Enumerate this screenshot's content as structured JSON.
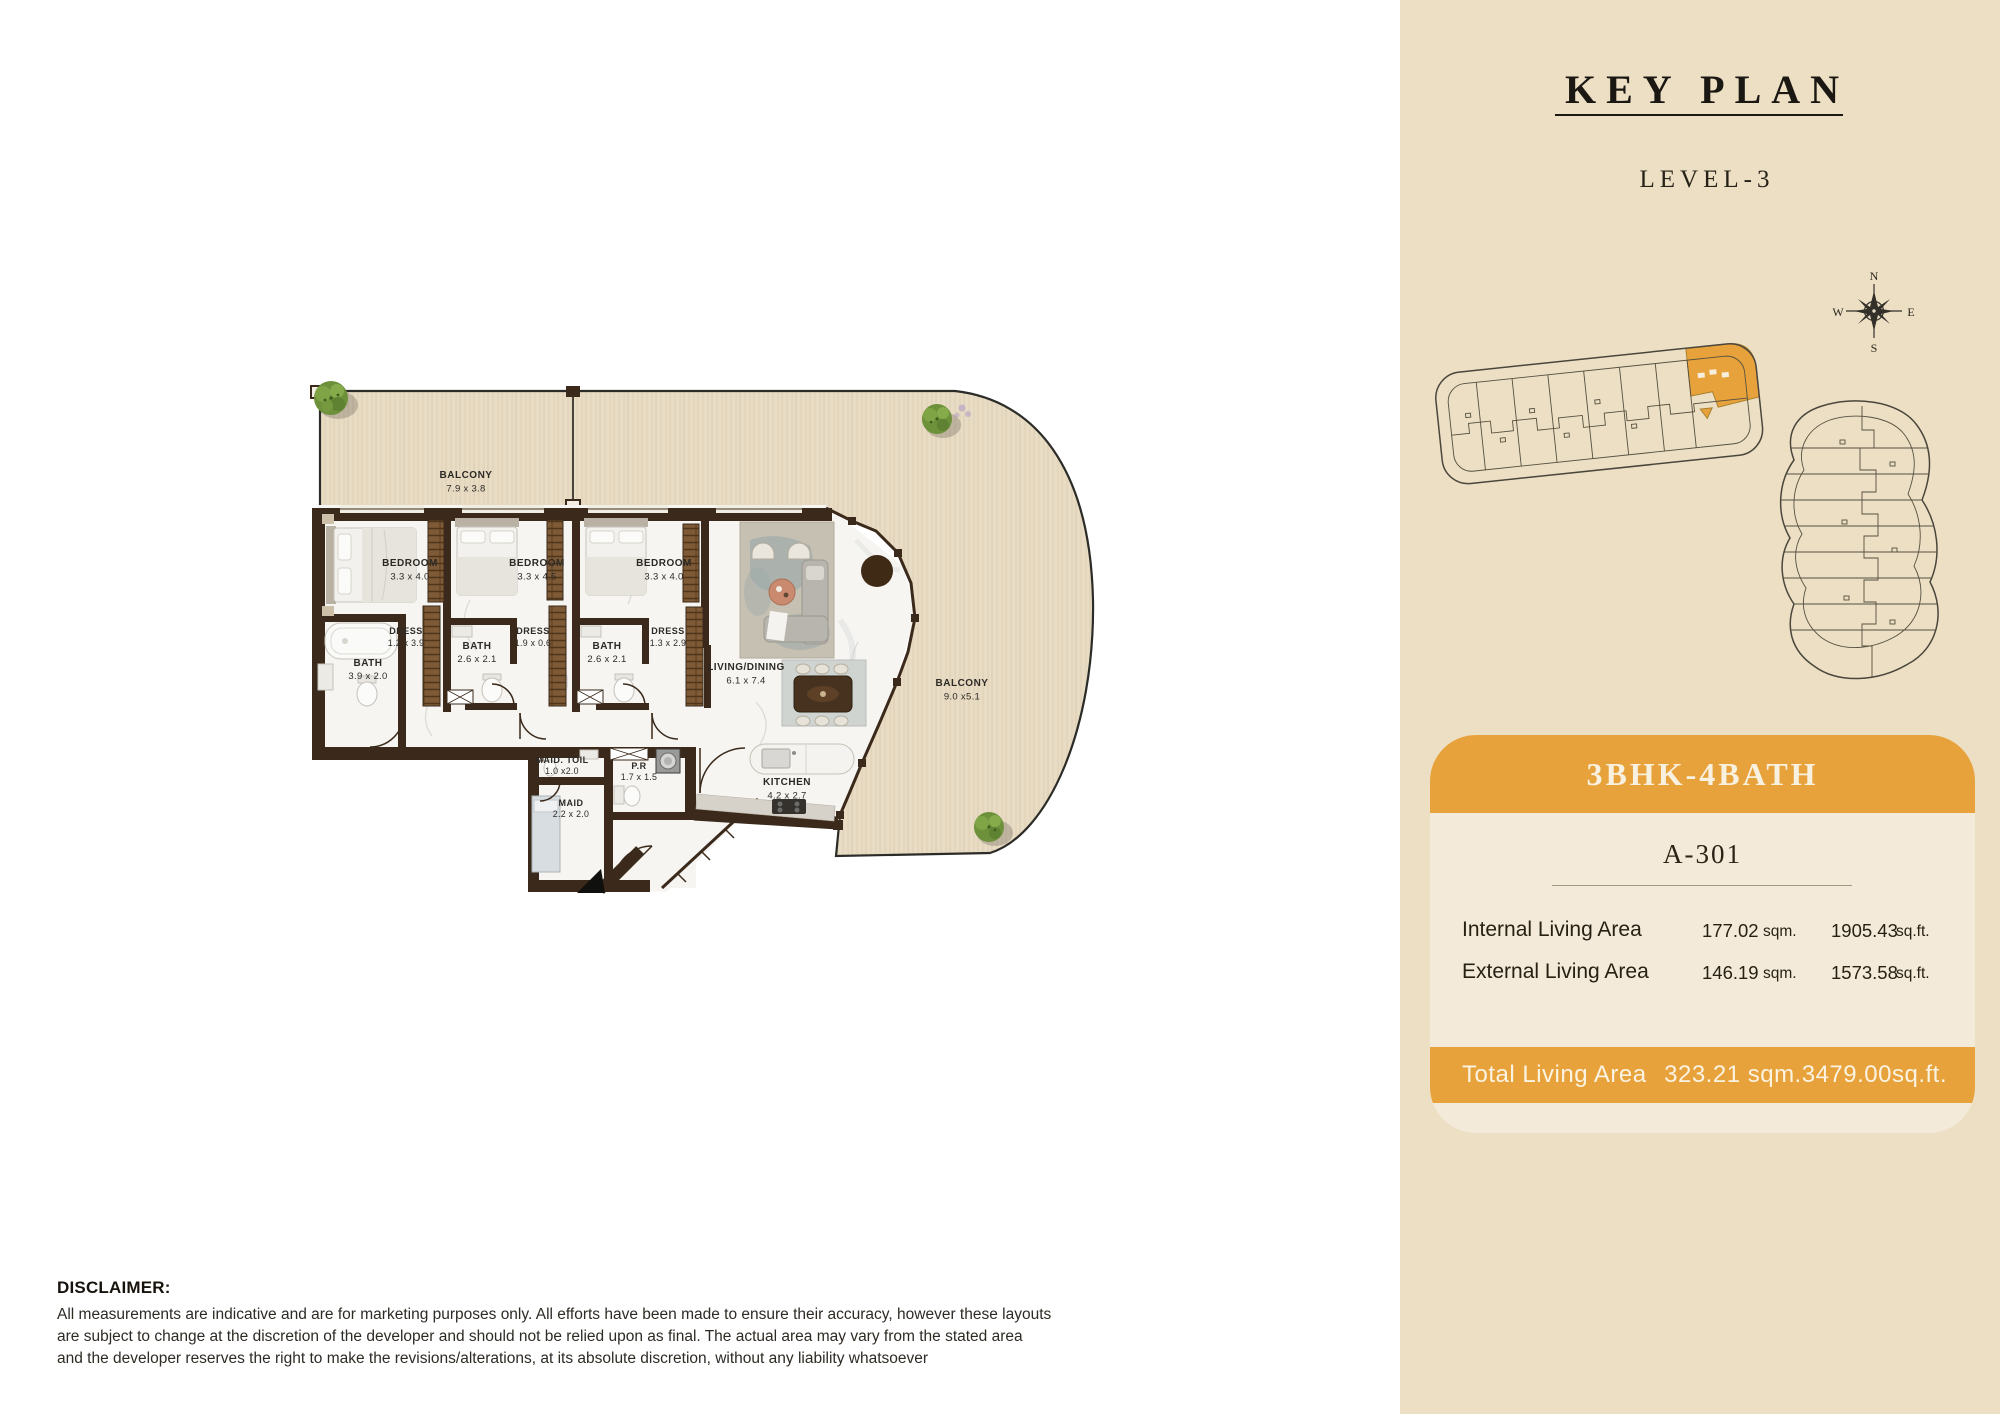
{
  "floorplan": {
    "rooms": [
      {
        "id": "balcony-top",
        "name": "BALCONY",
        "dims": "7.9 x 3.8"
      },
      {
        "id": "bedroom-1",
        "name": "BEDROOM",
        "dims": "3.3 x 4.0"
      },
      {
        "id": "bedroom-2",
        "name": "BEDROOM",
        "dims": "3.3 x 4.5"
      },
      {
        "id": "bedroom-3",
        "name": "BEDROOM",
        "dims": "3.3 x 4.0"
      },
      {
        "id": "dress-1",
        "name": "DRESS",
        "dims": "1.2 x 3.9"
      },
      {
        "id": "bath-1",
        "name": "BATH",
        "dims": "3.9 x 2.0"
      },
      {
        "id": "bath-2",
        "name": "BATH",
        "dims": "2.6 x 2.1"
      },
      {
        "id": "dress-2",
        "name": "DRESS",
        "dims": "1.9 x 0.6"
      },
      {
        "id": "bath-3",
        "name": "BATH",
        "dims": "2.6 x 2.1"
      },
      {
        "id": "dress-3",
        "name": "DRESS",
        "dims": "1.3 x 2.9"
      },
      {
        "id": "living-dining",
        "name": "LIVING/DINING",
        "dims": "6.1 x 7.4"
      },
      {
        "id": "balcony-right",
        "name": "BALCONY",
        "dims": "9.0 x5.1"
      },
      {
        "id": "kitchen",
        "name": "KITCHEN",
        "dims": "4.2 x 2.7"
      },
      {
        "id": "maid-toilet",
        "name": "MAID. TOIL",
        "dims": "1.0 x2.0"
      },
      {
        "id": "maid-room",
        "name": "MAID",
        "dims": "2.2 x 2.0"
      },
      {
        "id": "powder-room",
        "name": "P.R",
        "dims": "1.7 x 1.5"
      }
    ]
  },
  "keyplan": {
    "title": "KEY PLAN",
    "level": "LEVEL-3",
    "compass": {
      "n": "N",
      "e": "E",
      "s": "S",
      "w": "W"
    }
  },
  "unit_card": {
    "type": "3BHK-4BATH",
    "unit": "A-301",
    "rows": [
      {
        "label": "Internal Living Area",
        "sqm": "177.02",
        "sqm_unit": "sqm.",
        "sqft": "1905.43",
        "sqft_unit": "sq.ft."
      },
      {
        "label": "External Living Area",
        "sqm": "146.19",
        "sqm_unit": "sqm.",
        "sqft": "1573.58",
        "sqft_unit": "sq.ft."
      }
    ],
    "total": {
      "label": "Total Living Area",
      "value": "323.21 sqm.3479.00sq.ft."
    }
  },
  "disclaimer": {
    "title": "DISCLAIMER:",
    "lines": [
      "All measurements are indicative and are for marketing purposes only. All efforts have been made to ensure their accuracy, however these layouts",
      "are subject to change at the discretion of the developer and should not be relied upon as final. The actual area may vary from the stated area",
      "and the developer reserves the right to make the revisions/alterations, at its absolute discretion, without any liability whatsoever"
    ]
  },
  "colors": {
    "accent_orange": "#e8a23b",
    "panel_bg": "#ecdfc4",
    "card_bg": "#f3ead9",
    "wall_brown": "#3b2a1b",
    "balcony_wood": "#e9dcc4",
    "floor_white": "#f6f5f2",
    "keyplan_line": "#4a463c",
    "tree_green": "#6f923c"
  }
}
